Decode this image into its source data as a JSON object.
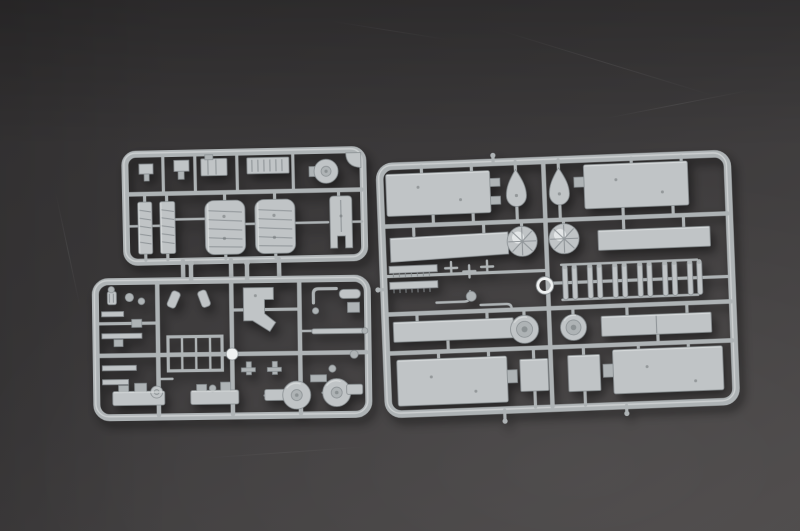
{
  "meta": {
    "type": "photograph",
    "subject": "Two light-gray injection-molded plastic model-kit sprues (parts runners) lying on a dark gray textured surface",
    "width_px": 800,
    "height_px": 531,
    "visible_text": "none"
  },
  "theme": {
    "bg-top": "#353334",
    "bg-mid": "#3c3a3b",
    "bg-low": "#4b4848",
    "plastic": "#aeb3b5",
    "plastic-light": "#c0c4c6",
    "plastic-lighter": "#dbdedf",
    "plastic-dark": "#878d90",
    "plastic-darker": "#6f7477",
    "shine": "#eff1f1"
  },
  "scene": {
    "surface": {
      "label": "dark charcoal tabletop with faint scratches",
      "scratch_count": 5
    },
    "sprues": [
      {
        "id": "sprue-upper-left",
        "label": "Upper-left sprue: small fittings, grated plate, winch drum, two ladder strips, two ribbed curved hatch panels, forked hull piece; three cut runner stubs below",
        "parts": [
          "bracket-small",
          "fitting-small",
          "detail-box",
          "grated-plate",
          "winch-drum",
          "corner-gusset",
          "ladder-strip",
          "ladder-strip",
          "ribbed-hatch-panel",
          "ribbed-hatch-panel",
          "forked-hull-piece",
          "runner-stub",
          "runner-stub",
          "runner-stub"
        ]
      },
      {
        "id": "sprue-lower-left",
        "label": "Lower-left sprue: many small fittings, lattice frame, mounting bracket, rods, two machinery assemblies, two round blower fans; two cut runner stubs above",
        "parts": [
          "knurled-cylinder",
          "clamp-rings",
          "flat-bars",
          "angled-foot",
          "angled-foot",
          "mounting-bracket",
          "pipe-elbow",
          "cylinder-fitting",
          "lattice-frame",
          "shiny-runner-node",
          "long-rod",
          "t-fittings",
          "machinery-assembly",
          "machinery-assembly",
          "blower-fan",
          "blower-fan",
          "runner-stub",
          "runner-stub"
        ]
      },
      {
        "id": "sprue-right",
        "label": "Right sprue: large flat deck/hull panels, two shield-shaped ventilators, two faceted domes, serrated strips, six paired bollard posts, two turret rings, two deckhouse blocks",
        "parts": [
          "deck-panel-large",
          "deck-panel-large",
          "shield-ventilator",
          "shield-ventilator",
          "deck-strip",
          "dome-faceted",
          "dome-faceted",
          "deck-strip",
          "serrated-strip",
          "serrated-strip",
          "cleat-fittings",
          "pipe-run",
          "ring-fitting",
          "shiny-ring",
          "bollard-pair-x6",
          "deck-strip",
          "turret-ring",
          "turret-ring",
          "deck-strip",
          "hull-panel-large",
          "deckhouse-block",
          "deckhouse-block",
          "hull-panel-large",
          "runner-stub",
          "runner-stub",
          "runner-stub"
        ]
      }
    ]
  }
}
